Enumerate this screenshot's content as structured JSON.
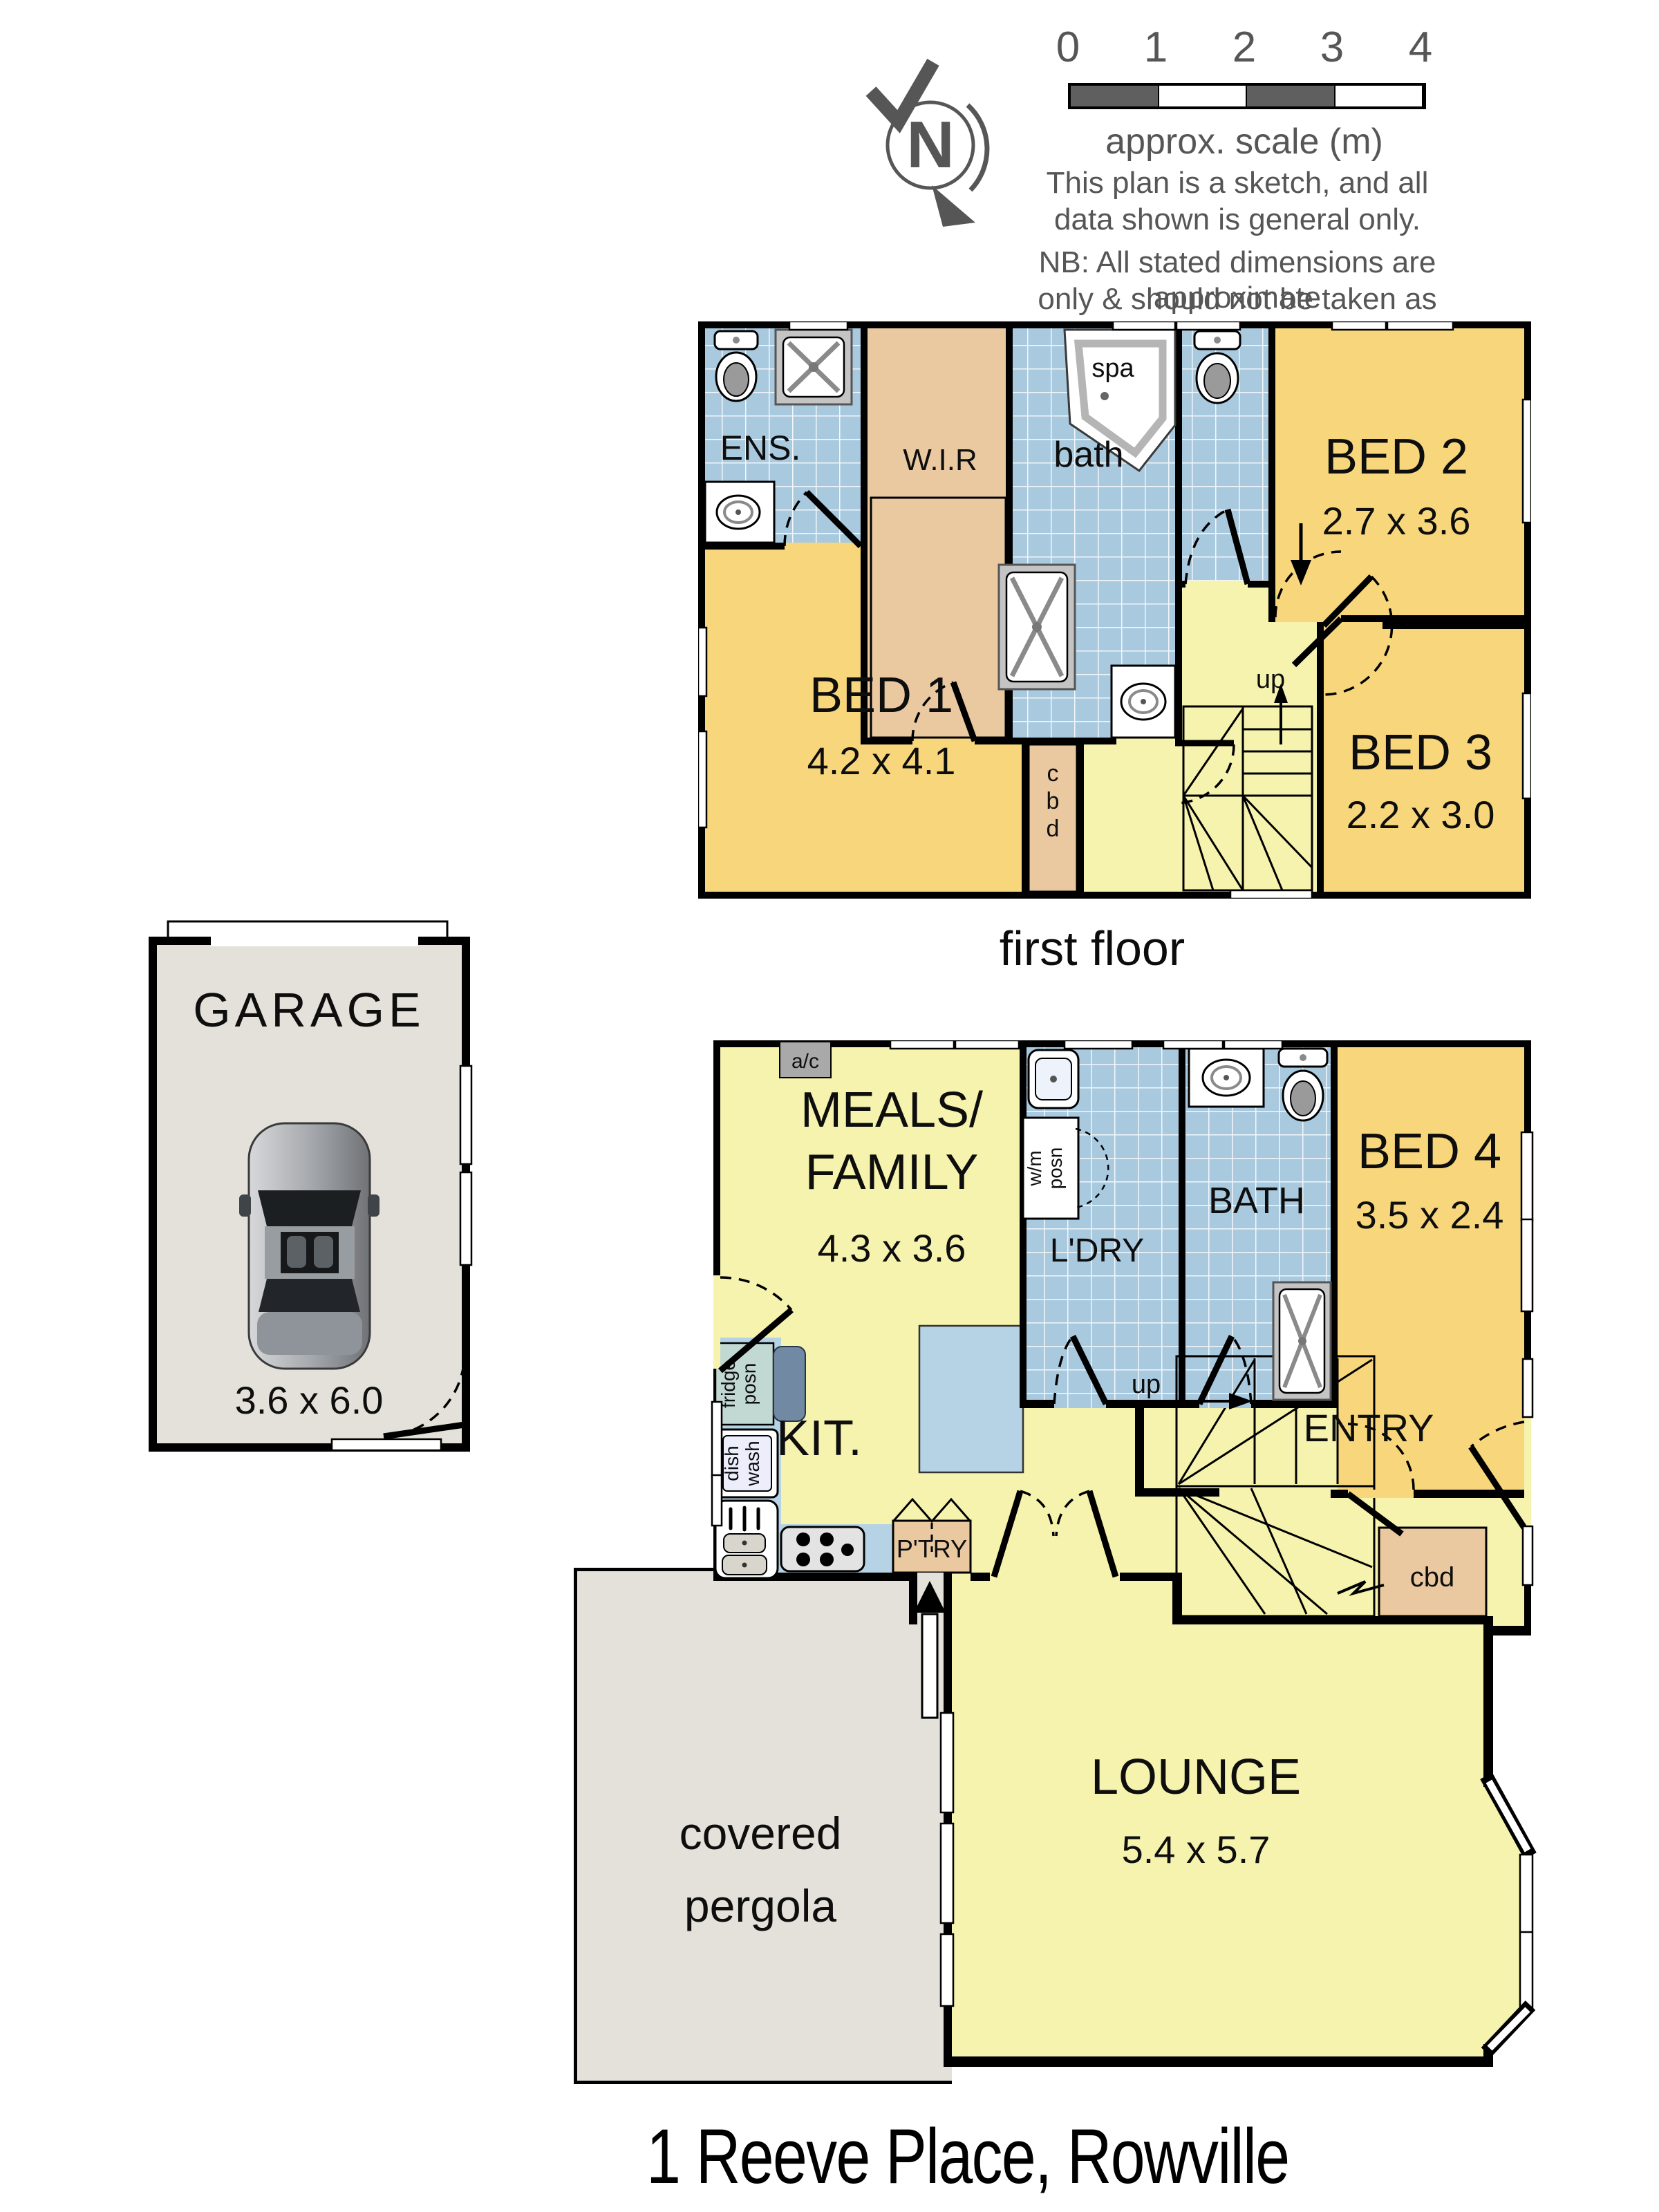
{
  "compass": {
    "letter": "N"
  },
  "scale_bar": {
    "ticks": [
      "0",
      "1",
      "2",
      "3",
      "4"
    ],
    "caption": "approx. scale (m)"
  },
  "disclaimer": {
    "line1": "This plan is a sketch, and all",
    "line2": "data shown is general only."
  },
  "nb": {
    "line1": "NB: All stated dimensions are approximate",
    "line2": "only & should not be taken as definite."
  },
  "first_floor": {
    "caption": "first floor",
    "ens": "ENS.",
    "wir": "W.I.R",
    "bath": "bath",
    "spa": "spa",
    "bed1": {
      "name": "BED 1",
      "dims": "4.2 x 4.1"
    },
    "bed2": {
      "name": "BED 2",
      "dims": "2.7 x 3.6"
    },
    "bed3": {
      "name": "BED 3",
      "dims": "2.2 x 3.0"
    },
    "cbd": [
      "c",
      "b",
      "d"
    ],
    "up": "up"
  },
  "garage": {
    "name": "GARAGE",
    "dims": "3.6 x 6.0"
  },
  "ground_floor": {
    "ac": "a/c",
    "meals": {
      "line1": "MEALS/",
      "line2": "FAMILY",
      "dims": "4.3 x 3.6"
    },
    "wm": [
      "w/m",
      "posn"
    ],
    "ldry": "L'DRY",
    "bath": "BATH",
    "bed4": {
      "name": "BED 4",
      "dims": "3.5 x 2.4"
    },
    "fridge": [
      "fridge",
      "posn"
    ],
    "dish": [
      "dish",
      "wash"
    ],
    "kit": "KIT.",
    "ptry": "P'TRY",
    "entry": "ENTRY",
    "up": "up",
    "cbd": "cbd",
    "pergola": {
      "line1": "covered",
      "line2": "pergola"
    },
    "lounge": {
      "name": "LOUNGE",
      "dims": "5.4 x 5.7"
    }
  },
  "footer": {
    "address": "1 Reeve Place, Rowville"
  },
  "colors": {
    "bedroom_gold": "#f8d77c",
    "living_yellow": "#f6f3ae",
    "tile_blue": "#a9c9df",
    "robe_tan": "#eac9a1",
    "outdoor_grey": "#e3e1d9",
    "counter_blue": "#b5d3e4",
    "wall_black": "#000000",
    "scale_grey": "#5f5f5f"
  }
}
